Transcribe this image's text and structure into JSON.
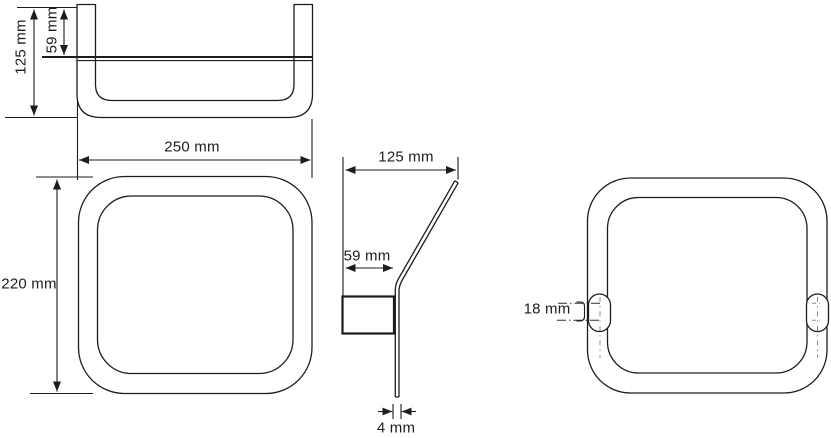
{
  "colors": {
    "background": "#ffffff",
    "line": "#1d1d1b",
    "centerline": "#8c8c8c"
  },
  "views": {
    "top": {
      "depth": "125 mm",
      "plate_depth": "59 mm",
      "width": "250 mm"
    },
    "front": {
      "height": "220 mm"
    },
    "side": {
      "depth": "125 mm",
      "plate_depth": "59 mm",
      "thickness": "4 mm"
    },
    "back": {
      "tab_height": "18 mm"
    }
  }
}
